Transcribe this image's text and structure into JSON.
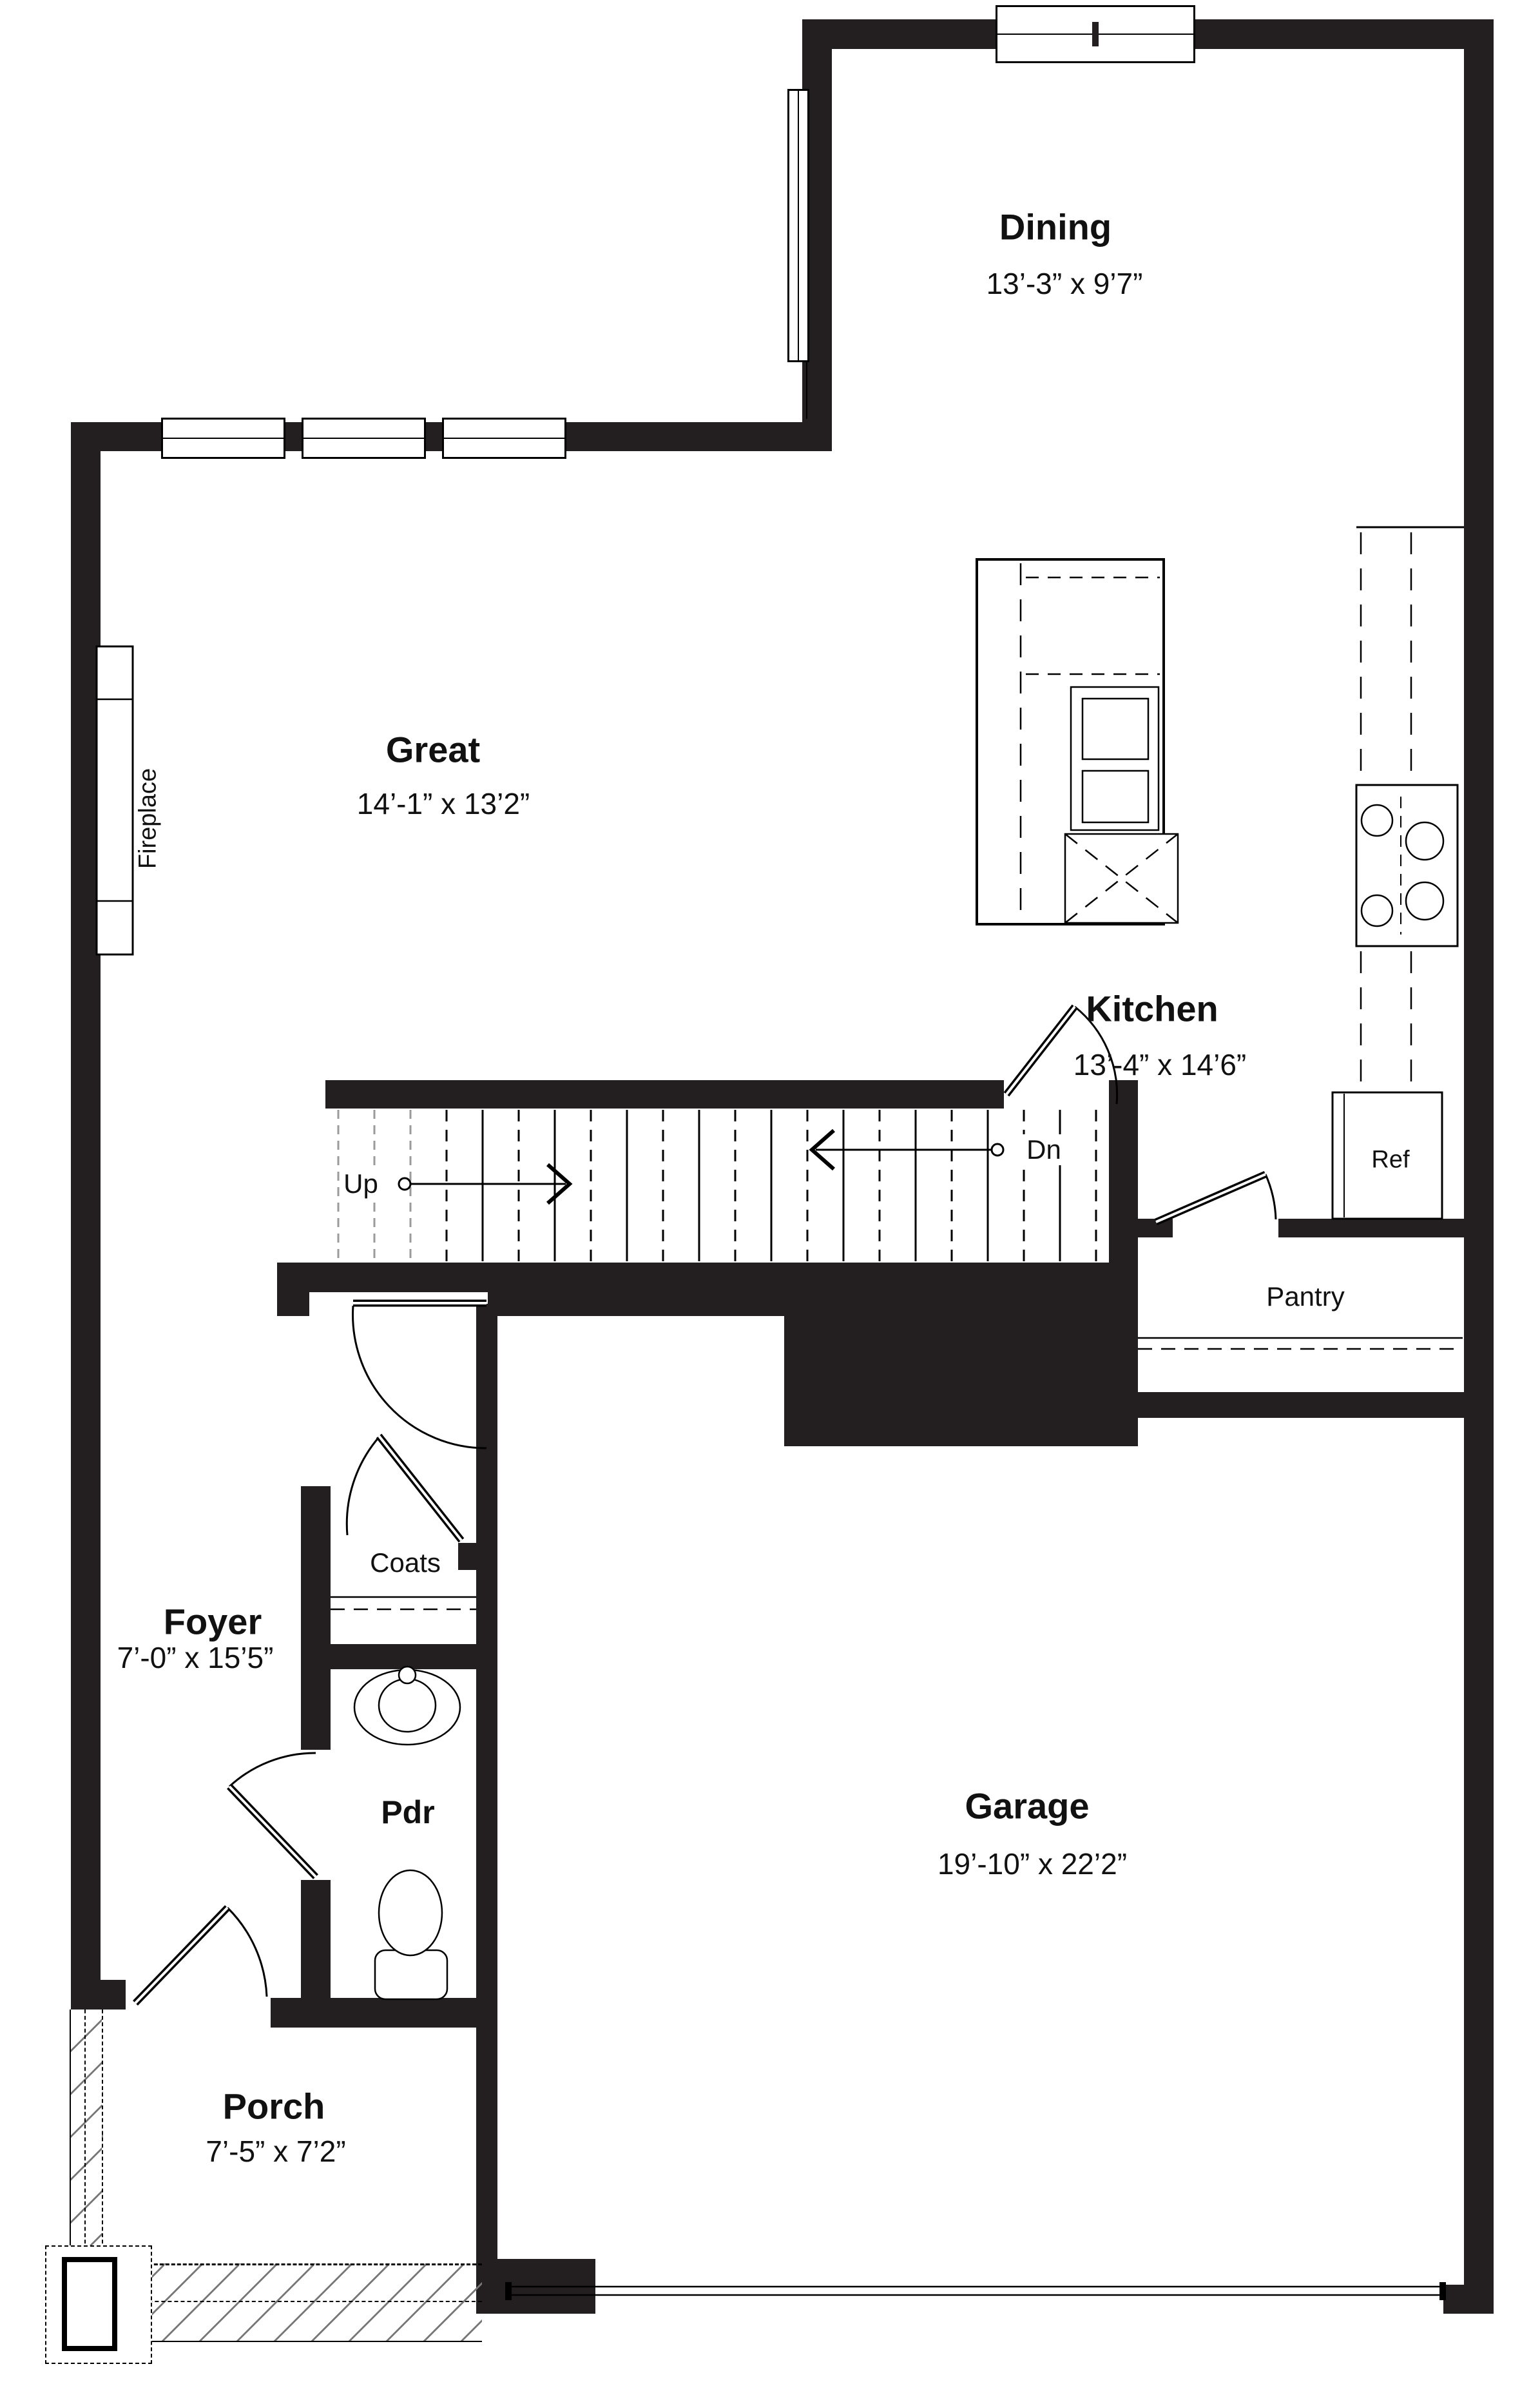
{
  "plan": {
    "rooms": {
      "dining": {
        "name": "Dining",
        "dims": "13’-3” x 9’7”"
      },
      "great": {
        "name": "Great",
        "dims": "14’-1” x 13’2”"
      },
      "kitchen": {
        "name": "Kitchen",
        "dims": "13’-4” x 14’6”"
      },
      "garage": {
        "name": "Garage",
        "dims": "19’-10” x 22’2”"
      },
      "foyer": {
        "name": "Foyer",
        "dims": "7’-0” x 15’5”"
      },
      "porch": {
        "name": "Porch",
        "dims": "7’-5” x 7’2”"
      },
      "powder": {
        "name": "Pdr"
      }
    },
    "features": {
      "fireplace": "Fireplace",
      "coats": "Coats",
      "pantry": "Pantry",
      "refrigerator": "Ref",
      "stairs_up": "Up",
      "stairs_down": "Dn"
    },
    "colors": {
      "wall": "#231f20",
      "line": "#000000",
      "background": "#ffffff",
      "stair_ghost": "#9a9a9a",
      "hatch": "#777777"
    }
  }
}
